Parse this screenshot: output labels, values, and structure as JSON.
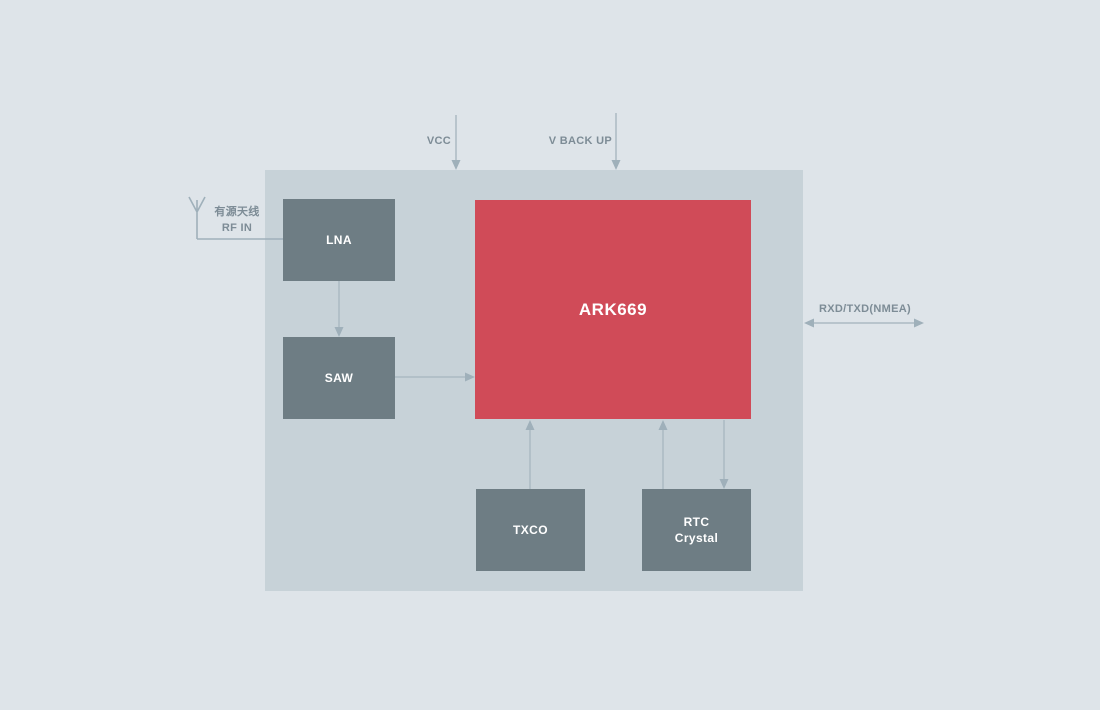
{
  "diagram": {
    "type": "block-diagram",
    "blocks": {
      "lna": {
        "label": "LNA"
      },
      "saw": {
        "label": "SAW"
      },
      "chip": {
        "label": "ARK669"
      },
      "txco": {
        "label": "TXCO"
      },
      "rtc": {
        "label_line1": "RTC",
        "label_line2": "Crystal"
      }
    },
    "labels": {
      "vcc": "VCC",
      "v_backup": "V BACK UP",
      "rxd_txd": "RXD/TXD(NMEA)",
      "antenna_line1": "有源天线",
      "antenna_line2": "RF IN"
    },
    "connections": [
      {
        "from": "antenna",
        "to": "LNA",
        "style": "plain-line"
      },
      {
        "from": "VCC",
        "to": "module",
        "style": "arrow-down"
      },
      {
        "from": "V BACK UP",
        "to": "module",
        "style": "arrow-down"
      },
      {
        "from": "LNA",
        "to": "SAW",
        "style": "arrow-down"
      },
      {
        "from": "SAW",
        "to": "ARK669",
        "style": "arrow-right"
      },
      {
        "from": "TXCO",
        "to": "ARK669",
        "style": "arrow-up"
      },
      {
        "from": "RTC Crystal",
        "to": "ARK669",
        "style": "arrow-up"
      },
      {
        "from": "ARK669",
        "to": "RTC Crystal",
        "style": "arrow-down"
      },
      {
        "from": "ARK669",
        "to": "RXD/TXD(NMEA)",
        "style": "arrow-both"
      }
    ],
    "colors": {
      "background": "#dee4e9",
      "module_fill": "#c7d2d8",
      "block_fill": "#6e7d84",
      "chip_fill": "#d04b58",
      "block_text": "#ffffff",
      "label_text": "#7d8c96",
      "wire": "#abbac3",
      "wire_head": "#9fb0ba"
    }
  }
}
